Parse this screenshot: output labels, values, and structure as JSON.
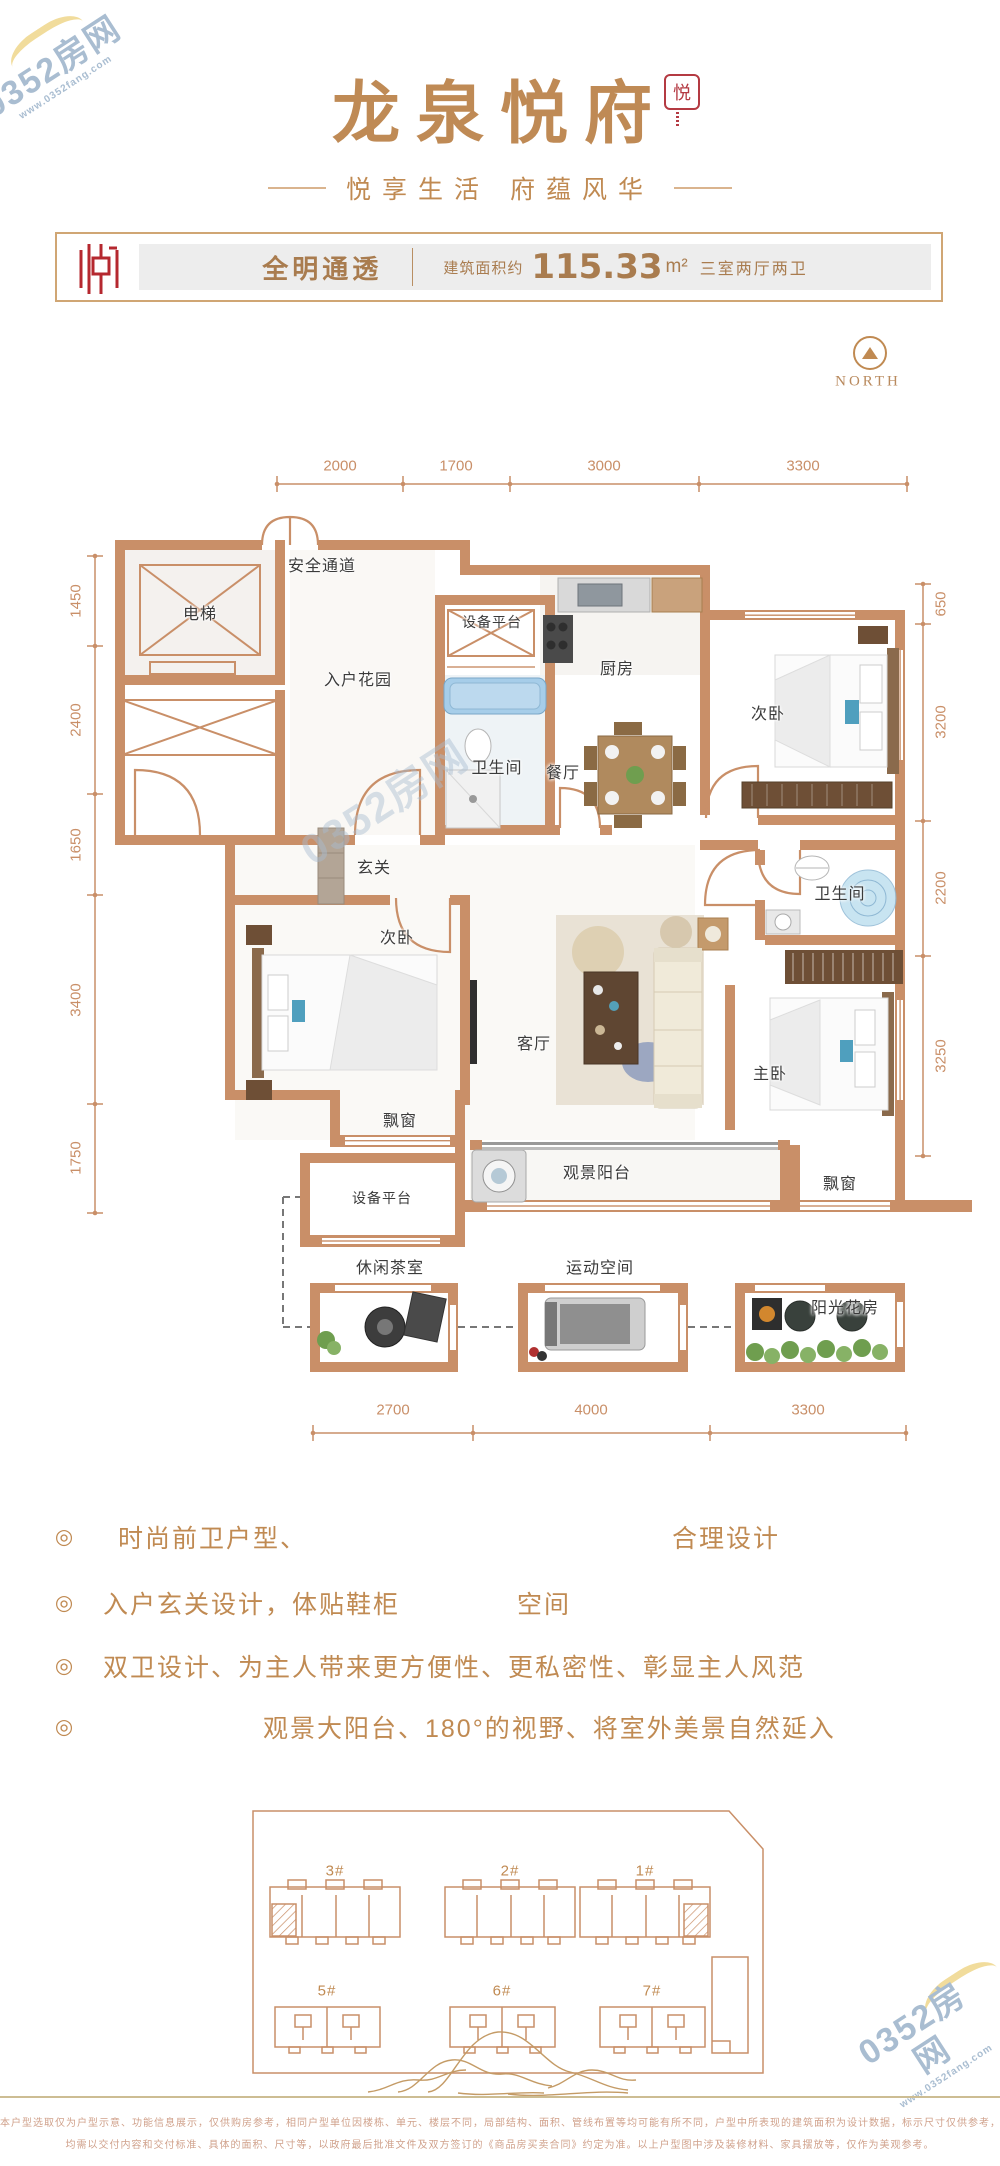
{
  "watermark": {
    "text": "0352房网",
    "url": "www.0352fang.com"
  },
  "header": {
    "title": "龙泉悦府",
    "seal": "悦",
    "subtitle_left": "悦享生活",
    "subtitle_right": "府蕴风华"
  },
  "info_bar": {
    "tag": "全明通透",
    "area_label": "建筑面积约",
    "area_value": "115.33",
    "area_unit": "m²",
    "rooms_summary": "三室两厅两卫"
  },
  "north_label": "NORTH",
  "plan": {
    "dims_top": [
      "2000",
      "1700",
      "3000",
      "3300"
    ],
    "dims_left": [
      "1450",
      "2400",
      "1650",
      "3400",
      "1750"
    ],
    "dims_right": [
      "650",
      "3200",
      "2200",
      "3250"
    ],
    "dims_bottom": [
      "2700",
      "4000",
      "3300"
    ],
    "rooms": {
      "elevator": "电梯",
      "safe_passage": "安全通道",
      "entry_garden": "入户花园",
      "equip_platform_top": "设备平台",
      "bathroom_top": "卫生间",
      "kitchen": "厨房",
      "dining": "餐厅",
      "bedroom_top_right": "次卧",
      "hallway": "玄关",
      "bedroom_left": "次卧",
      "living": "客厅",
      "bathroom_right": "卫生间",
      "master_bedroom": "主卧",
      "bay_window_left": "飘窗",
      "view_balcony": "观景阳台",
      "bay_window_right": "飘窗",
      "equip_platform_bottom": "设备平台",
      "tea_room": "休闲茶室",
      "sport_space": "运动空间",
      "sun_room": "阳光花房"
    }
  },
  "features": {
    "bullet": "◎",
    "items": [
      {
        "part1": "时尚前卫户型、",
        "part2": "合理设计"
      },
      {
        "part1": "入户玄关设计，体贴鞋柜",
        "part2": "空间"
      },
      {
        "part1": "双卫设计、为主人带来更方便性、更私密性、彰显主人风范",
        "part2": ""
      },
      {
        "part1": "观景大阳台、180°的视野、将室外美景自然延入",
        "part2": ""
      }
    ]
  },
  "site_plan": {
    "buildings_top": [
      "3#",
      "2#",
      "1#"
    ],
    "buildings_bottom": [
      "5#",
      "6#",
      "7#"
    ]
  },
  "footer": {
    "line1": "本户型选取仅为户型示意、功能信息展示，仅供购房参考，相同户型单位因楼栋、单元、楼层不同，局部结构、面积、管线布置等均可能有所不同，户型中所表现的建筑面积为设计数据，标示尺寸仅供参考，",
    "line2": "均需以交付内容和交付标准、具体的面积、尺寸等，以政府最后批准文件及双方签订的《商品房买卖合同》约定为准。以上户型图中涉及装修材料、家具摆放等，仅作为美观参考。"
  }
}
